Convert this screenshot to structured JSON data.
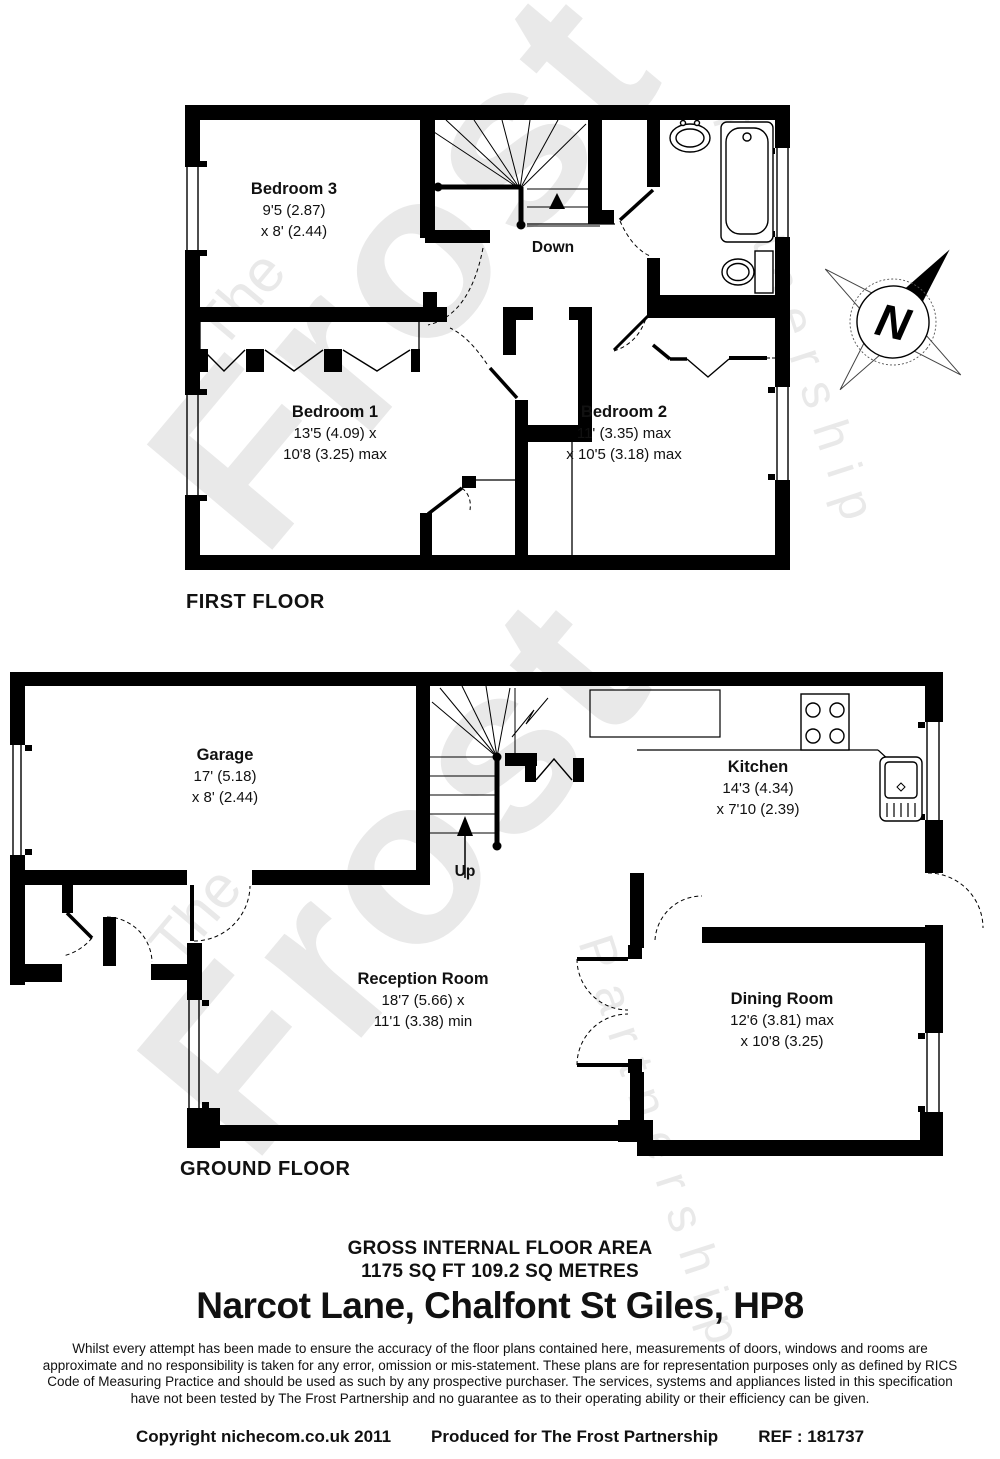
{
  "watermark": {
    "the": "The",
    "frost": "Frost",
    "partnership": "Partnership"
  },
  "compass": {
    "label": "N"
  },
  "first_floor": {
    "title": "FIRST FLOOR",
    "stairs_label": "Down",
    "rooms": [
      {
        "name": "Bedroom 3",
        "dim1": "9'5 (2.87)",
        "dim2": "x 8' (2.44)"
      },
      {
        "name": "Bedroom 1",
        "dim1": "13'5 (4.09) x",
        "dim2": "10'8 (3.25) max"
      },
      {
        "name": "Bedroom 2",
        "dim1": "11' (3.35) max",
        "dim2": "x 10'5 (3.18) max"
      }
    ]
  },
  "ground_floor": {
    "title": "GROUND FLOOR",
    "stairs_label": "Up",
    "rooms": [
      {
        "name": "Garage",
        "dim1": "17' (5.18)",
        "dim2": "x 8' (2.44)"
      },
      {
        "name": "Kitchen",
        "dim1": "14'3 (4.34)",
        "dim2": "x 7'10 (2.39)"
      },
      {
        "name": "Reception Room",
        "dim1": "18'7 (5.66) x",
        "dim2": "11'1 (3.38) min"
      },
      {
        "name": "Dining Room",
        "dim1": "12'6 (3.81) max",
        "dim2": "x 10'8 (3.25)"
      }
    ]
  },
  "footer": {
    "area_title": "GROSS INTERNAL FLOOR AREA",
    "area_value": "1175 SQ FT 109.2 SQ METRES",
    "address": "Narcot Lane, Chalfont St Giles, HP8",
    "disclaimer": "Whilst every attempt has been made to ensure the accuracy of the floor plans contained here, measurements of doors, windows and rooms are approximate and no responsibility is taken for any error, omission or mis-statement.  These plans are for representation purposes only as defined by RICS Code of Measuring Practice and should be used as such by any prospective purchaser.  The services, systems and appliances listed in this specification have not been tested by The Frost Partnership and no guarantee as to their operating ability or their efficiency can be given.",
    "copyright": "Copyright nichecom.co.uk 2011",
    "produced": "Produced for The Frost Partnership",
    "ref": "REF : 181737"
  }
}
